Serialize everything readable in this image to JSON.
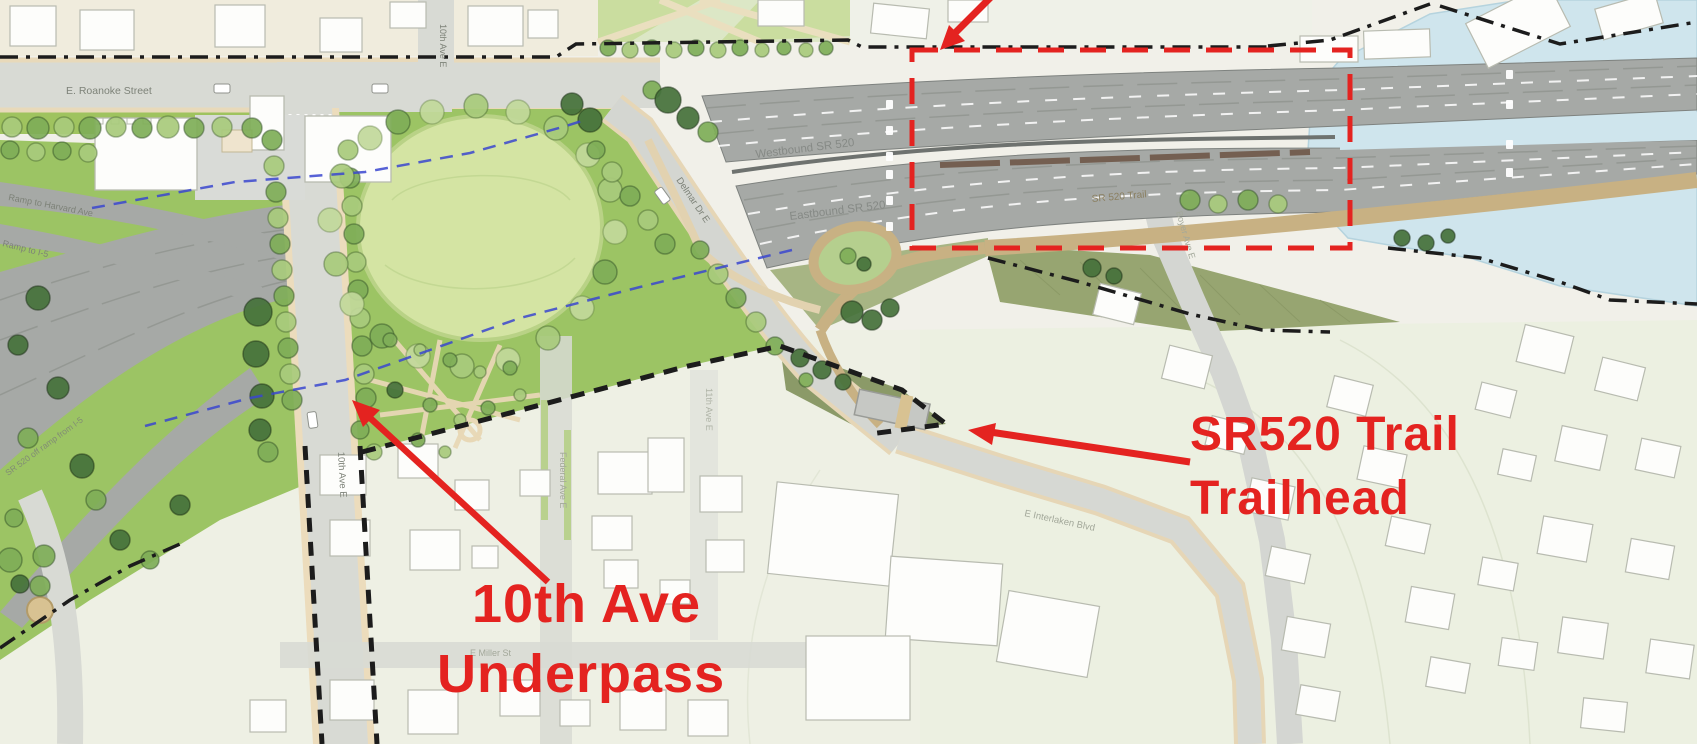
{
  "annotations": {
    "underpass_line1": "10th Ave",
    "underpass_line2": "Underpass",
    "trailhead_line1": "SR520 Trail",
    "trailhead_line2": "Trailhead"
  },
  "labels": {
    "roanoke": "E. Roanoke Street",
    "tenth_ave_north": "10th Ave E",
    "tenth_ave_south": "10th Ave E",
    "delmar": "Delmar Dr E",
    "westbound": "Westbound SR 520",
    "eastbound": "Eastbound SR 520",
    "sr520_trail": "SR 520 Trail",
    "ramp_harvard": "Ramp to Harvard Ave",
    "ramp_i5": "Ramp to I-5",
    "off_ramp": "SR 520 off ramp from I-5",
    "federal": "Federal Ave E",
    "eleventh": "11th Ave E",
    "miller": "E Miller St",
    "interlaken": "E Interlaken Blvd",
    "boyer": "Boyer Ave E"
  },
  "colors": {
    "annotation_red": "#e42320",
    "boundary_black": "#1c1c1c",
    "lid_edge_blue": "#3a46cf",
    "water": "#cfe5ed",
    "highway_gray": "#a6a9a6",
    "trail_tan": "#c8b183",
    "lawn_green": "#d4e4a3",
    "slope_green": "#9cc464"
  }
}
